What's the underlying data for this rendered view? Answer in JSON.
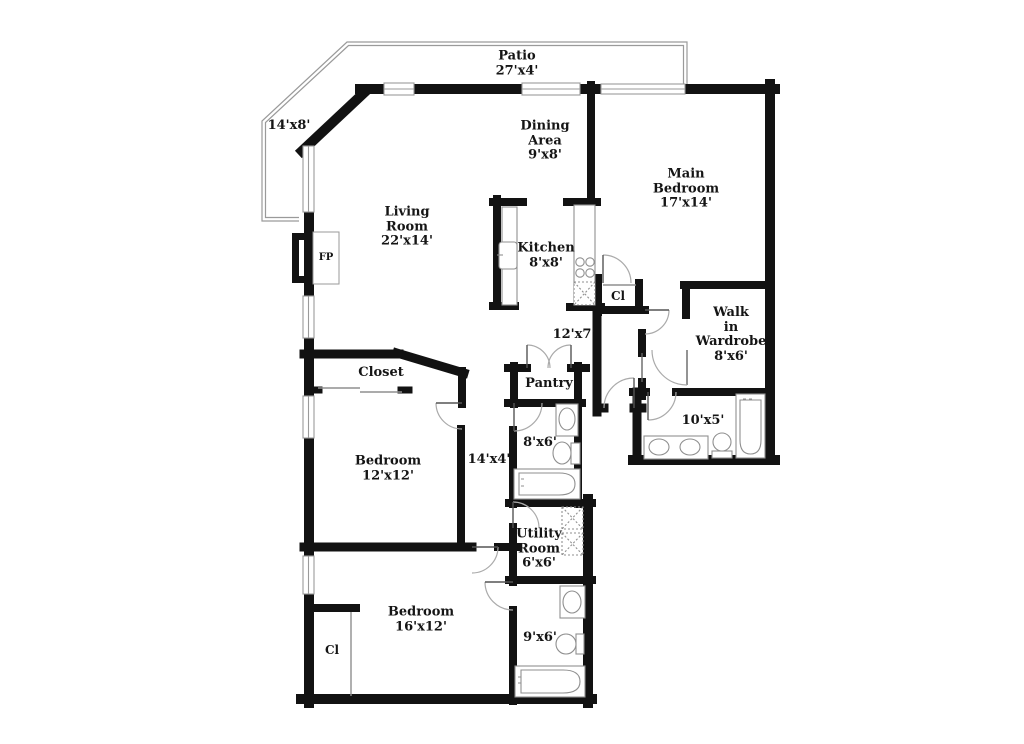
{
  "plan": {
    "type": "residential-floor-plan",
    "colors": {
      "background": "#ffffff",
      "wall": "#121212",
      "thin_line": "#8f8f8f",
      "text": "#151515"
    },
    "rooms": {
      "patio": {
        "lines": [
          "Patio",
          "27'x4'"
        ]
      },
      "balcony": {
        "lines": [
          "14'x8'"
        ]
      },
      "living": {
        "lines": [
          "Living",
          "Room",
          "22'x14'"
        ]
      },
      "dining": {
        "lines": [
          "Dining",
          "Area",
          "9'x8'"
        ]
      },
      "main_bedroom": {
        "lines": [
          "Main",
          "Bedroom",
          "17'x14'"
        ]
      },
      "kitchen": {
        "lines": [
          "Kitchen",
          "8'x8'"
        ]
      },
      "closet_main": {
        "lines": [
          "Cl"
        ]
      },
      "hall_upper": {
        "lines": [
          "12'x7'"
        ]
      },
      "wardrobe": {
        "lines": [
          "Walk",
          "in",
          "Wardrobe",
          "8'x6'"
        ]
      },
      "bath_main": {
        "lines": [
          "10'x5'"
        ]
      },
      "pantry": {
        "lines": [
          "Pantry"
        ]
      },
      "bath_hall": {
        "lines": [
          "8'x6'"
        ]
      },
      "closet": {
        "lines": [
          "Closet"
        ]
      },
      "bedroom2": {
        "lines": [
          "Bedroom",
          "12'x12'"
        ]
      },
      "hall_lower": {
        "lines": [
          "14'x4'"
        ]
      },
      "utility": {
        "lines": [
          "Utility",
          "Room",
          "6'x6'"
        ]
      },
      "bedroom3": {
        "lines": [
          "Bedroom",
          "16'x12'"
        ]
      },
      "closet_b3": {
        "lines": [
          "Cl"
        ]
      },
      "bath2": {
        "lines": [
          "9'x6'"
        ]
      },
      "fireplace": {
        "lines": [
          "FP"
        ]
      }
    }
  }
}
